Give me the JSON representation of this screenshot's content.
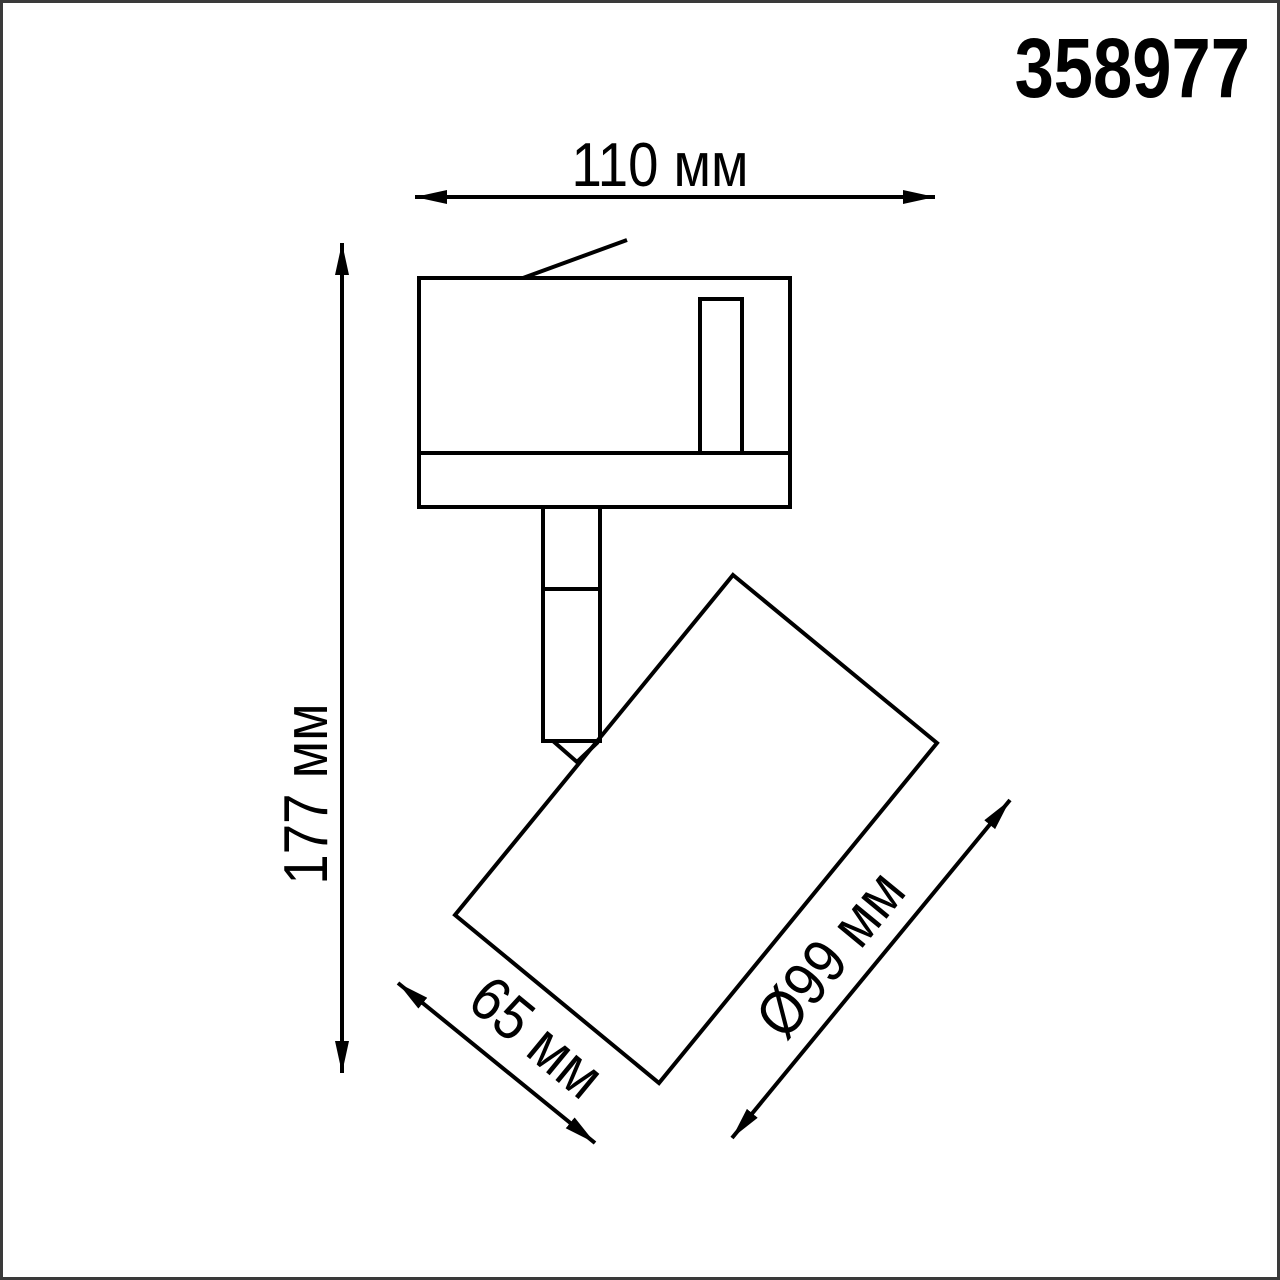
{
  "colors": {
    "background": "#ffffff",
    "frame": "#3a3a3a",
    "line": "#000000",
    "text": "#000000"
  },
  "header": {
    "article_number": "358977"
  },
  "drawing": {
    "dim_overall_width": {
      "label": "110 мм"
    },
    "dim_overall_height": {
      "label": "177 мм"
    },
    "dim_head_width": {
      "label": "65 мм"
    },
    "dim_head_diameter": {
      "label": "Ø99 мм"
    }
  }
}
